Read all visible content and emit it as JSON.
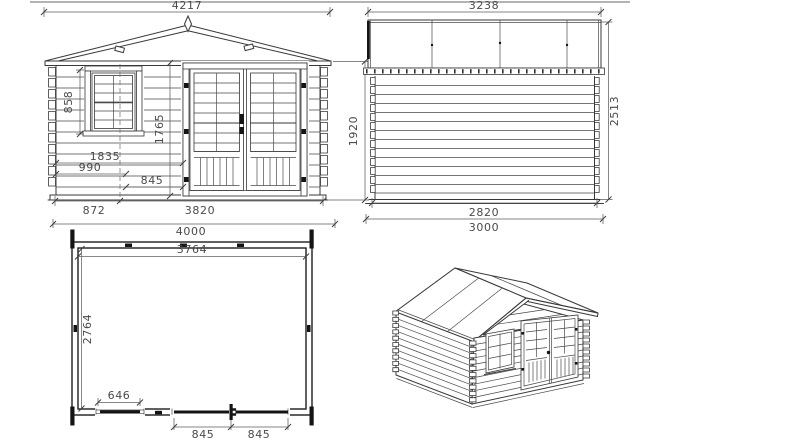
{
  "drawing": {
    "title": "log cabin dimensioned drawing",
    "front_elevation": {
      "overall_width": "4217",
      "window_height": "858",
      "door_height": "1765",
      "door_left_offset": "1835",
      "window_left_offset": "990",
      "door_leaf_width": "845",
      "window_center_offset": "872",
      "wall_width": "3820",
      "overall_base_width": "4000",
      "wall_height": "1920"
    },
    "side_elevation": {
      "overall_depth": "3238",
      "overall_height": "2513",
      "wall_depth": "2820",
      "overall_base_depth": "3000"
    },
    "floor_plan": {
      "inner_width": "3764",
      "inner_depth": "2764",
      "window_opening_width": "646",
      "door_leaf_left": "845",
      "door_leaf_right": "845"
    },
    "colors": {
      "line": "#383838",
      "heavy": "#141414",
      "dimension": "#5f5f5f",
      "text": "#4a4a4a",
      "page_edge": "#9c9c9c"
    }
  }
}
